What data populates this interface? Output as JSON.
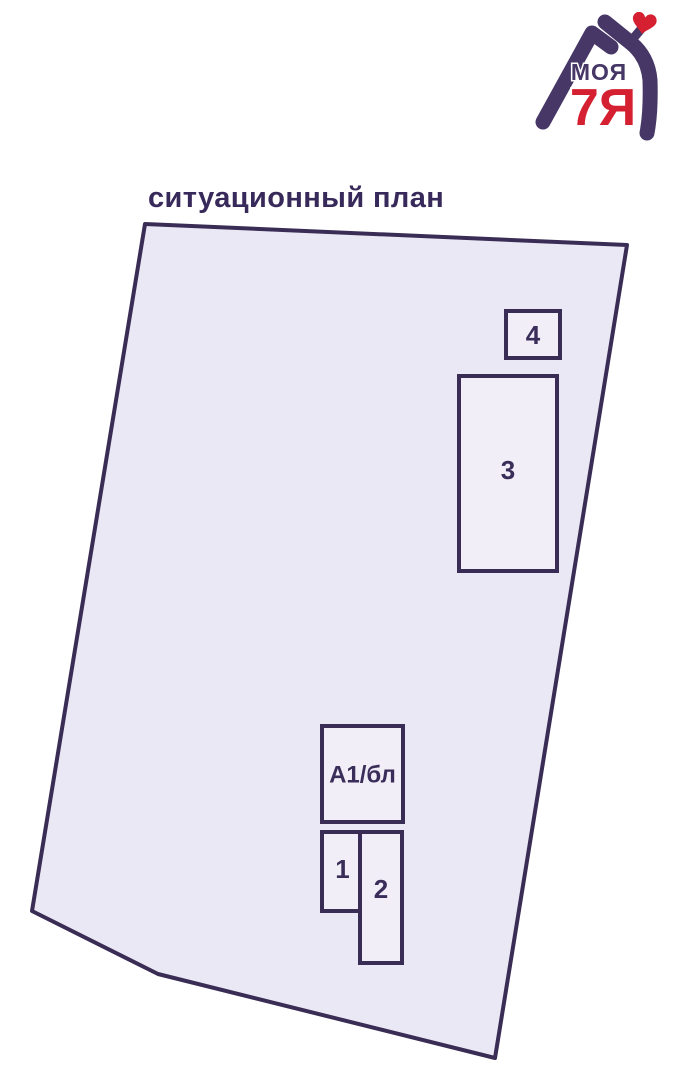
{
  "page": {
    "title": "ситуационный план",
    "title_color": "#38295b",
    "background": "#ffffff"
  },
  "logo": {
    "brand_top": "МОЯ",
    "brand_bottom": "7Я",
    "purple": "#463767",
    "red": "#d42030",
    "icons": [
      "house-arms-icon",
      "heart-icon"
    ]
  },
  "plan": {
    "colors": {
      "stroke": "#3a2d55",
      "plot_fill": "#ebe8f5",
      "building_fill": "#f1eef8",
      "label": "#3b2d5a"
    },
    "plot": {
      "name": "land-plot",
      "points": "145,224 627,245 495,1058 158,974 32,911",
      "stroke_width": 4
    },
    "buildings": [
      {
        "id": "4",
        "label": "4",
        "x": 506,
        "y": 311,
        "w": 54,
        "h": 47,
        "label_dy": 0
      },
      {
        "id": "3",
        "label": "3",
        "x": 459,
        "y": 376,
        "w": 98,
        "h": 195,
        "label_dy": -4
      },
      {
        "id": "a1",
        "label": "А1/бл",
        "x": 322,
        "y": 726,
        "w": 81,
        "h": 96,
        "label_dy": 0
      },
      {
        "id": "1",
        "label": "1",
        "x": 322,
        "y": 832,
        "w": 41,
        "h": 79,
        "label_dy": -3
      },
      {
        "id": "2",
        "label": "2",
        "x": 360,
        "y": 832,
        "w": 42,
        "h": 131,
        "label_dy": -9
      }
    ]
  }
}
